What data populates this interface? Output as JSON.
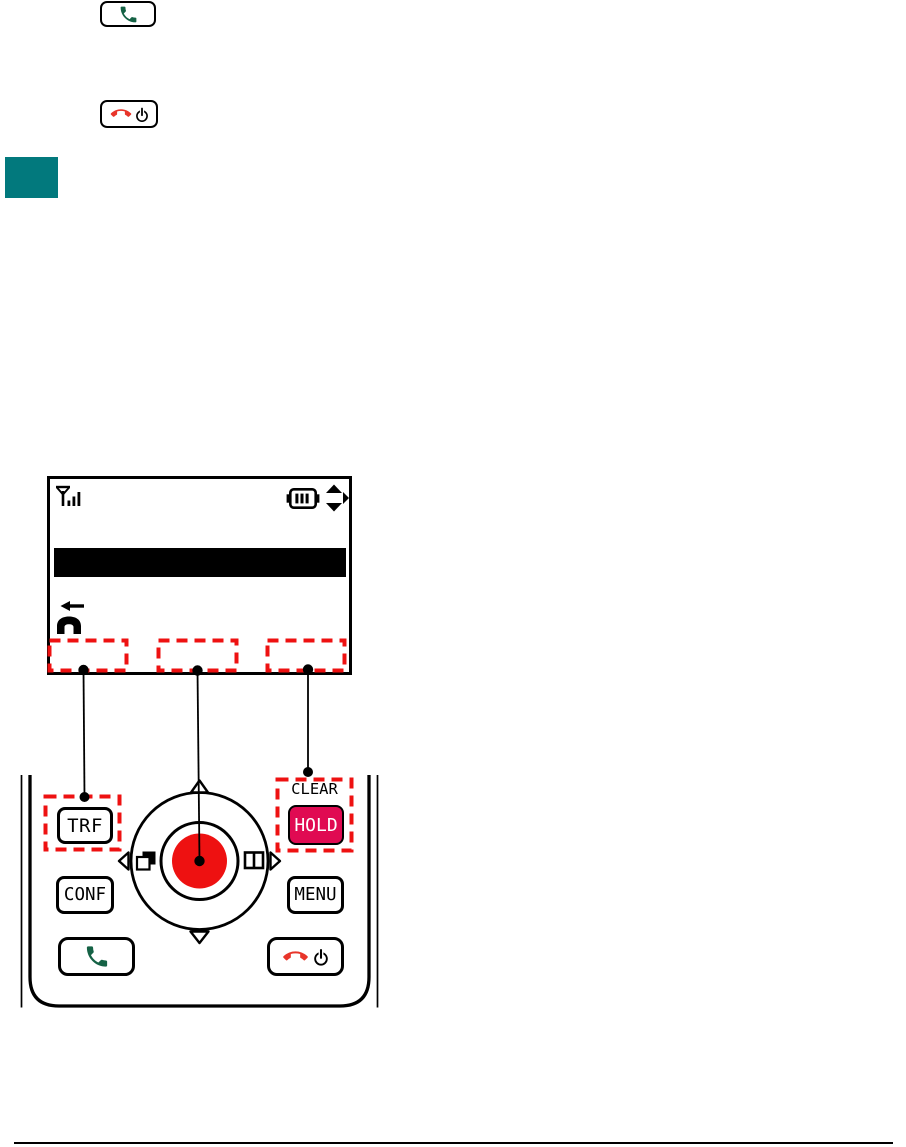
{
  "page": {
    "background": "#ffffff",
    "has_footer_rule": true
  },
  "inline_keys": {
    "talk": {
      "icon": "green-handset"
    },
    "end_power": {
      "icons": [
        "red-handset",
        "power"
      ]
    }
  },
  "section_marker": {
    "color": "#02797d"
  },
  "lcd": {
    "status_icons": [
      "signal-strength",
      "battery-level",
      "scroll-indicator"
    ],
    "highlight_bar": true,
    "event_icon": "incoming-call-handset",
    "softkey_highlight_count": 3
  },
  "handset_keys": {
    "trf": "TRF",
    "conf": "CONF",
    "menu": "MENU",
    "hold": "HOLD",
    "clear": "CLEAR"
  },
  "colors": {
    "dashed_highlight": "#ee1111",
    "hold_button": "#e00a52",
    "nav_center_button": "#ee1111",
    "green_handset": "#156245",
    "red_handset": "#e8352a",
    "section_marker": "#02797d"
  }
}
